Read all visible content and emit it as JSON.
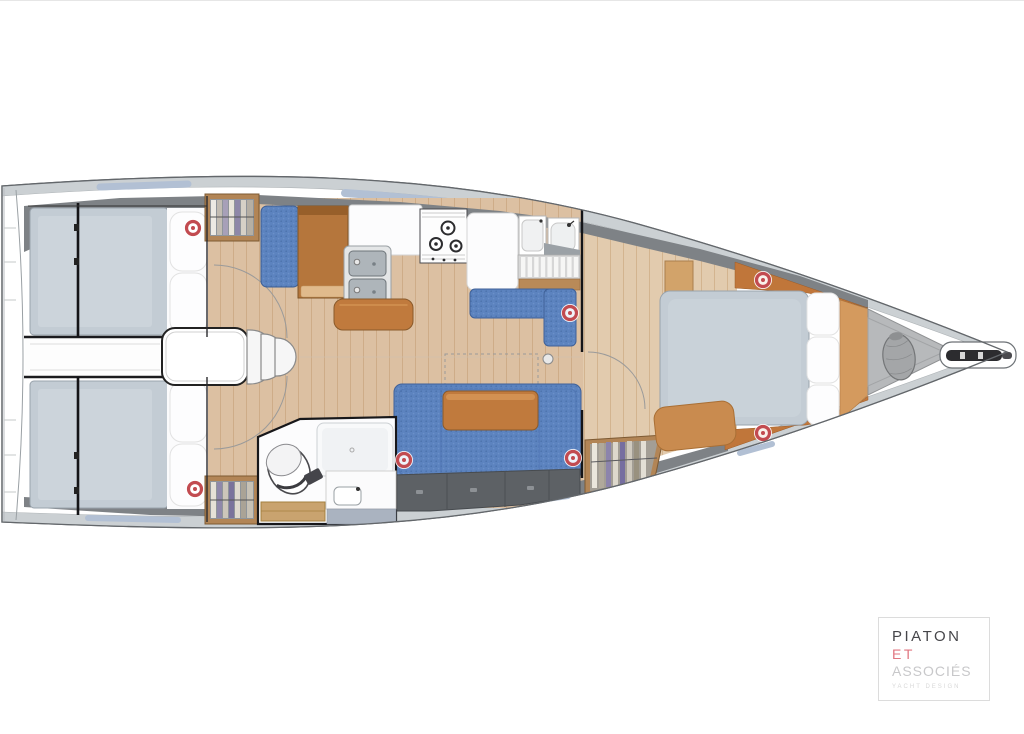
{
  "logo": {
    "line1": "PIATON",
    "line2": "ET",
    "line3": "ASSOCIÉS",
    "tagline": "YACHT DESIGN"
  },
  "palette": {
    "accent_red": "#c24b50",
    "upholstery_blue": "#5c83bf",
    "wood": "#c07a3d",
    "floor": "#dcc0a2",
    "mattress": "#c3ccd4",
    "deck_band": "#cbd0d3",
    "window_blue": "#b2c0d4",
    "side_deck": "#7e8286",
    "locker_grey": "#5d6165",
    "hull_line": "#63676b",
    "logo_red": "#e17680"
  }
}
